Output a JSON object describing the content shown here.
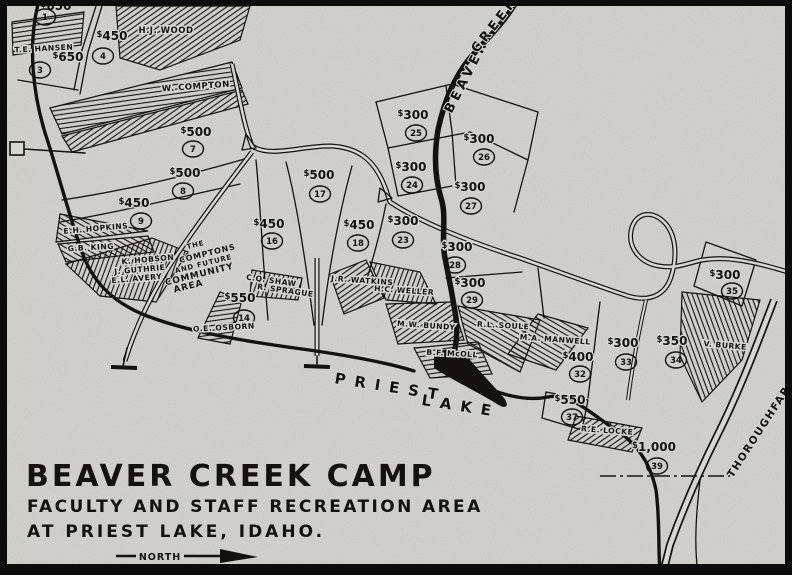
{
  "colors": {
    "paper": "#d7d5d0",
    "ink": "#15120e"
  },
  "title": {
    "line1": "BEAVER CREEK CAMP",
    "line2": "FACULTY AND STAFF RECREATION AREA",
    "line3": "AT PRIEST LAKE, IDAHO.",
    "north_label": "NORTH"
  },
  "water_labels": [
    {
      "text": "BEAVER",
      "x": 470,
      "y": 78,
      "rotate": -63,
      "size": 13,
      "spacing": 4
    },
    {
      "text": "CREEK",
      "x": 498,
      "y": 27,
      "rotate": -52,
      "size": 13,
      "spacing": 4
    },
    {
      "text": "PRIEST",
      "x": 390,
      "y": 392,
      "rotate": 9,
      "size": 15,
      "spacing": 9
    },
    {
      "text": "LAKE",
      "x": 460,
      "y": 411,
      "rotate": 9,
      "size": 15,
      "spacing": 9
    },
    {
      "text": "THOROUGHFARE",
      "x": 764,
      "y": 430,
      "rotate": -57,
      "size": 10.5,
      "spacing": 1.5
    }
  ],
  "community_area": [
    {
      "text": "THE",
      "x": 196,
      "y": 247,
      "rotate": -14,
      "size": 7
    },
    {
      "text": "COMPTONS",
      "x": 208,
      "y": 256,
      "rotate": -14,
      "size": 8
    },
    {
      "text": "AND FUTURE",
      "x": 204,
      "y": 266,
      "rotate": -14,
      "size": 7
    },
    {
      "text": "COMMUNITY",
      "x": 200,
      "y": 277,
      "rotate": -14,
      "size": 9
    },
    {
      "text": "AREA",
      "x": 189,
      "y": 289,
      "rotate": -14,
      "size": 9
    }
  ],
  "lots": [
    {
      "price": "$650",
      "number": "1",
      "px": 56,
      "py": 10,
      "cx": 45,
      "cy": 17
    },
    {
      "price": "$650",
      "number": "3",
      "px": 68,
      "py": 61,
      "cx": 40,
      "cy": 70
    },
    {
      "price": "$450",
      "number": "4",
      "px": 112,
      "py": 40,
      "cx": 103,
      "cy": 56
    },
    {
      "price": "$500",
      "number": "7",
      "px": 196,
      "py": 136,
      "cx": 193,
      "cy": 149
    },
    {
      "price": "$500",
      "number": "8",
      "px": 185,
      "py": 177,
      "cx": 183,
      "cy": 191
    },
    {
      "price": "$450",
      "number": "9",
      "px": 134,
      "py": 207,
      "cx": 141,
      "cy": 221
    },
    {
      "price": "$550",
      "number": "14",
      "px": 240,
      "py": 302,
      "cx": 244,
      "cy": 318
    },
    {
      "price": "$450",
      "number": "16",
      "px": 269,
      "py": 228,
      "cx": 272,
      "cy": 241
    },
    {
      "price": "$500",
      "number": "17",
      "px": 319,
      "py": 179,
      "cx": 320,
      "cy": 194
    },
    {
      "price": "$450",
      "number": "18",
      "px": 359,
      "py": 229,
      "cx": 358,
      "cy": 243
    },
    {
      "price": "$300",
      "number": "23",
      "px": 403,
      "py": 225,
      "cx": 403,
      "cy": 240
    },
    {
      "price": "$300",
      "number": "24",
      "px": 411,
      "py": 171,
      "cx": 412,
      "cy": 185
    },
    {
      "price": "$300",
      "number": "25",
      "px": 413,
      "py": 119,
      "cx": 416,
      "cy": 133
    },
    {
      "price": "$300",
      "number": "26",
      "px": 479,
      "py": 143,
      "cx": 484,
      "cy": 157
    },
    {
      "price": "$300",
      "number": "27",
      "px": 470,
      "py": 191,
      "cx": 471,
      "cy": 206
    },
    {
      "price": "$300",
      "number": "28",
      "px": 457,
      "py": 251,
      "cx": 455,
      "cy": 265
    },
    {
      "price": "$300",
      "number": "29",
      "px": 470,
      "py": 287,
      "cx": 472,
      "cy": 300
    },
    {
      "price": "$400",
      "number": "32",
      "px": 578,
      "py": 361,
      "cx": 580,
      "cy": 374
    },
    {
      "price": "$300",
      "number": "33",
      "px": 623,
      "py": 347,
      "cx": 626,
      "cy": 362
    },
    {
      "price": "$350",
      "number": "34",
      "px": 672,
      "py": 345,
      "cx": 676,
      "cy": 360
    },
    {
      "price": "$300",
      "number": "35",
      "px": 725,
      "py": 279,
      "cx": 732,
      "cy": 291
    },
    {
      "price": "$550",
      "number": "37",
      "px": 570,
      "py": 404,
      "cx": 572,
      "cy": 417
    },
    {
      "price": "$1,000",
      "number": "39",
      "px": 654,
      "py": 451,
      "cx": 657,
      "cy": 466
    }
  ],
  "owners": [
    {
      "name": "T.E. HANSEN",
      "x": 44,
      "y": 51,
      "rotate": -3
    },
    {
      "name": "H.J. WOOD",
      "x": 166,
      "y": 33,
      "rotate": 0,
      "size": 8.5
    },
    {
      "name": "W. COMPTON",
      "x": 196,
      "y": 89,
      "rotate": -4,
      "size": 8.5
    },
    {
      "name": "E.H. HOPKINS",
      "x": 96,
      "y": 231,
      "rotate": -5
    },
    {
      "name": "G.B. KING",
      "x": 91,
      "y": 250,
      "rotate": -3
    },
    {
      "name": "K. HOBSON",
      "x": 148,
      "y": 262,
      "rotate": -5
    },
    {
      "name": "J. GUTHRIE",
      "x": 140,
      "y": 272,
      "rotate": -5
    },
    {
      "name": "E.L. AVERY",
      "x": 137,
      "y": 281,
      "rotate": -5
    },
    {
      "name": "O.E. OSBORN",
      "x": 224,
      "y": 330,
      "rotate": -3
    },
    {
      "name": "C.Q. SHAW",
      "x": 271,
      "y": 283,
      "rotate": 8
    },
    {
      "name": "R. SPRAGUE",
      "x": 285,
      "y": 293,
      "rotate": 8
    },
    {
      "name": "J.R. WATKINS",
      "x": 362,
      "y": 283,
      "rotate": 4
    },
    {
      "name": "H.C. WELLER",
      "x": 404,
      "y": 293,
      "rotate": 4
    },
    {
      "name": "M.W. BUNDY",
      "x": 426,
      "y": 328,
      "rotate": 4
    },
    {
      "name": "B.F. McOLL",
      "x": 452,
      "y": 356,
      "rotate": 3
    },
    {
      "name": "R.L. SOULE",
      "x": 503,
      "y": 328,
      "rotate": 3
    },
    {
      "name": "M.A. MANWELL",
      "x": 555,
      "y": 342,
      "rotate": 4
    },
    {
      "name": "V. BURKE",
      "x": 725,
      "y": 348,
      "rotate": 5
    },
    {
      "name": "R.E. LOCKE",
      "x": 607,
      "y": 433,
      "rotate": 4
    }
  ]
}
